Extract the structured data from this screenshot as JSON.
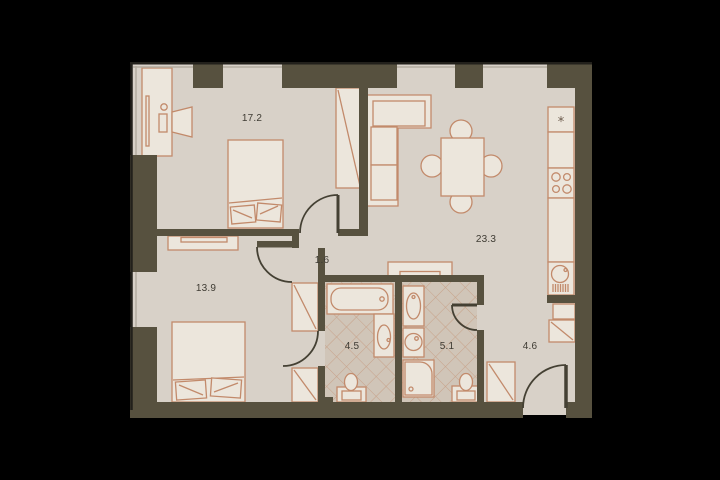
{
  "plan_title": "apartment-floor-plan",
  "rooms": [
    {
      "id": "bedroom-1",
      "area": "17.2"
    },
    {
      "id": "living-kitchen",
      "area": "23.3"
    },
    {
      "id": "corridor",
      "area": "1.6"
    },
    {
      "id": "bedroom-2",
      "area": "13.9"
    },
    {
      "id": "bathroom-ensuite",
      "area": "4.5"
    },
    {
      "id": "bathroom",
      "area": "5.1"
    },
    {
      "id": "hallway",
      "area": "4.6"
    }
  ],
  "kitchen": {
    "fridge_symbol": "*"
  },
  "colors": {
    "background": "#000000",
    "floor": "#d8d1c8",
    "tile_floor": "#d0c5b8",
    "tile_line": "#c49a7e",
    "wall": "#57513f",
    "door_line": "#444033",
    "furniture_stroke": "#c28a6b",
    "furniture_fill": "#ece6dc",
    "label_text": "#3e3b33"
  },
  "fixtures": [
    "bed",
    "pillow",
    "wardrobe",
    "desk",
    "desk-chair",
    "sofa",
    "dining-table",
    "dining-chair",
    "tv-stand",
    "bathtub",
    "vanity-sink",
    "toilet",
    "shower",
    "washing-machine",
    "fridge",
    "cooktop",
    "kitchen-counter",
    "kitchen-sink",
    "entrance-door",
    "interior-door",
    "window"
  ]
}
